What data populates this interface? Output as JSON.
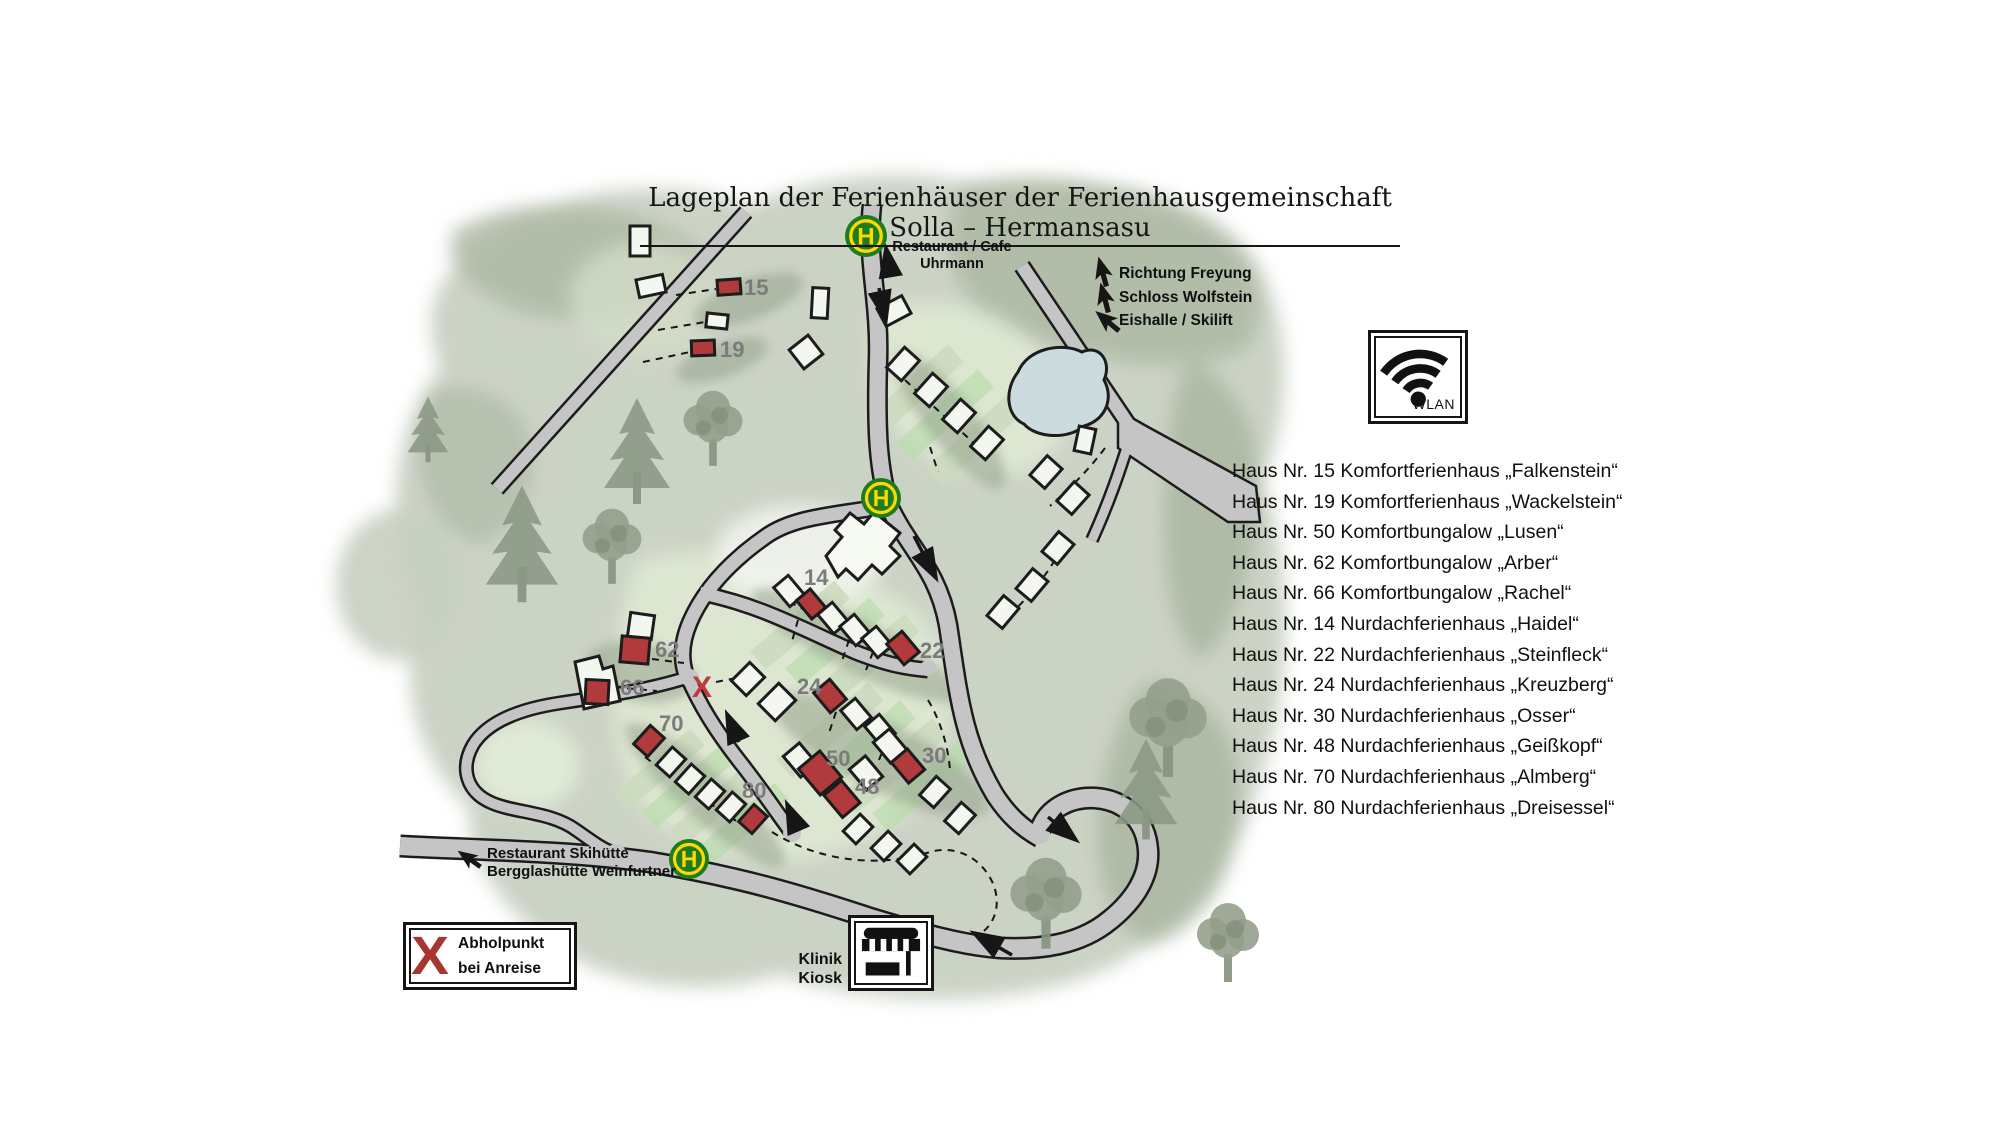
{
  "title": "Lageplan der Ferienhäuser der Ferienhausgemeinschaft Solla – Hermansasu",
  "bus_stop": {
    "letter": "H"
  },
  "poi": {
    "restaurant_cafe": {
      "line1": "Restaurant / Cafe",
      "line2": "Uhrmann"
    },
    "directions": [
      {
        "label": "Richtung Freyung"
      },
      {
        "label": "Schloss Wolfstein"
      },
      {
        "label": "Eishalle / Skilift"
      }
    ],
    "ski": {
      "line1": "Restaurant Skihütte",
      "line2": "Bergglashütte Weinfurtner"
    },
    "kiosk": {
      "line1": "Klinik",
      "line2": "Kiosk"
    },
    "pickup": {
      "mark": "X",
      "line1": "Abholpunkt",
      "line2": "bei Anreise"
    },
    "wlan": {
      "label": "WLAN"
    },
    "route_x": "X"
  },
  "houses": {
    "red_numbers": [
      "15",
      "19",
      "62",
      "66",
      "70",
      "80",
      "14",
      "22",
      "24",
      "50",
      "48",
      "30"
    ]
  },
  "legend": {
    "items": [
      "Haus Nr. 15 Komfortferienhaus „Falkenstein“",
      "Haus Nr. 19 Komfortferienhaus „Wackelstein“",
      "Haus Nr. 50 Komfortbungalow „Lusen“",
      "Haus Nr. 62 Komfortbungalow „Arber“",
      "Haus Nr. 66 Komfortbungalow „Rachel“",
      "Haus Nr. 14 Nurdachferienhaus „Haidel“",
      "Haus Nr. 22 Nurdachferienhaus „Steinfleck“",
      "Haus Nr. 24 Nurdachferienhaus „Kreuzberg“",
      "Haus Nr. 30 Nurdachferienhaus „Osser“",
      "Haus Nr. 48 Nurdachferienhaus „Geißkopf“",
      "Haus Nr. 70 Nurdachferienhaus „Almberg“",
      "Haus Nr. 80 Nurdachferienhaus „Dreisessel“"
    ]
  },
  "colors": {
    "house_red": "#b13a3c",
    "bus_stop_green": "#1e7c20",
    "bus_stop_yellow": "#ffd800",
    "pickup_x_red": "#a8352f",
    "route_x_red": "#bf3a3a",
    "road_grey": "#c5c5c5",
    "number_grey": "#7b7b7b",
    "pond_blue": "#ccdbde"
  }
}
